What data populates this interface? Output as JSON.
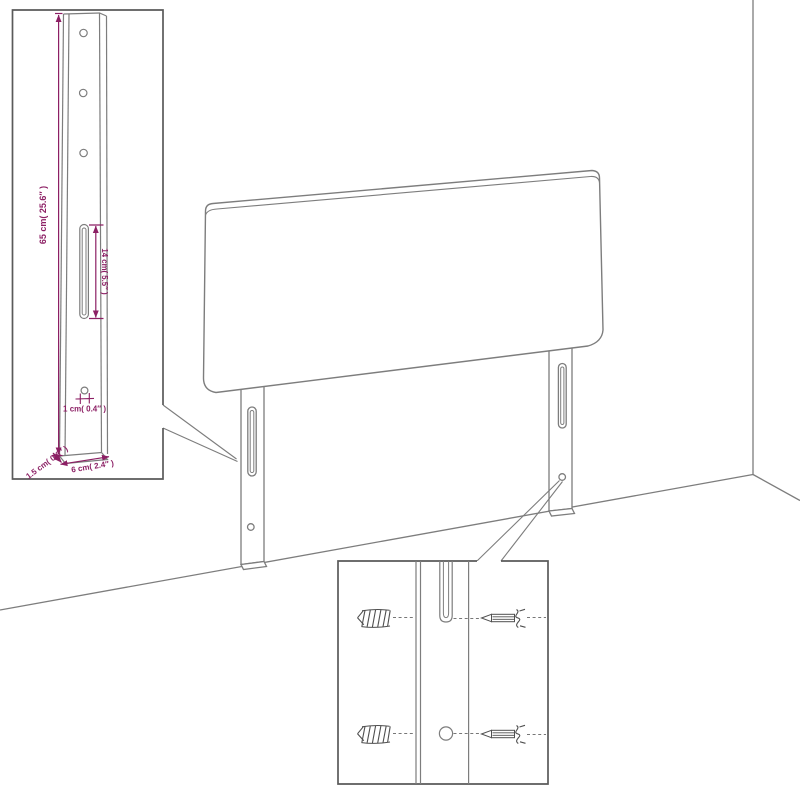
{
  "diagram": {
    "name": "Headboard assembly dimension diagram",
    "colors": {
      "line_gray": "#7d7d7d",
      "dark_gray": "#4f4f4f",
      "box_border": "#5a5a5a",
      "accent_purple": "#8c1f64",
      "background": "#ffffff"
    },
    "callout_left": {
      "labels": {
        "height": "65 cm( 25.6″ )",
        "slot_height": "14 cm( 5.5″ )",
        "hole_diameter": "1 cm( 0.4″ )",
        "depth": "1.5 cm( 0.6″ )",
        "width": "6 cm( 2.4″ )"
      }
    }
  }
}
